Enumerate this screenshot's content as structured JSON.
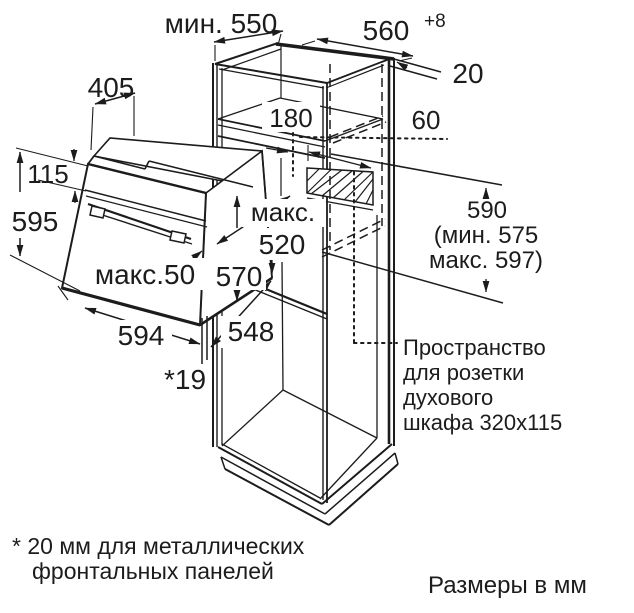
{
  "diagram": {
    "dims": {
      "min_depth": "мин. 550",
      "niche_width": "560",
      "niche_width_tolerance": "+8",
      "rear_gap": "20",
      "top_depth": "405",
      "vent_offset_front": "180",
      "vent_offset_top": "60",
      "panel_height": "115",
      "front_height": "595",
      "max_label": "макс.",
      "body_depth_max": "520",
      "body_height": "570",
      "front_protrusion_max": "макс.50",
      "niche_height": "590",
      "niche_height_min": "(мин. 575",
      "niche_height_max": "макс. 597)",
      "front_width": "594",
      "body_width": "548",
      "frame_overhang": "*19"
    },
    "socket_note": [
      "Пространство",
      "для розетки",
      "духового",
      "шкафа 320x115"
    ],
    "footnote": [
      "* 20 мм для металлических",
      "фронтальных панелей"
    ],
    "units_note": "Размеры в мм",
    "colors": {
      "line": "#1c1c1c",
      "background": "#ffffff"
    }
  }
}
